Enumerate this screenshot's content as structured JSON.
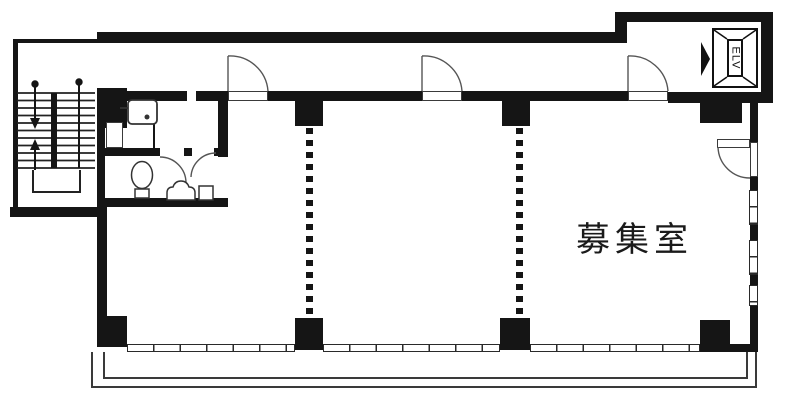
{
  "plan": {
    "room_label": "募集室",
    "elevator_label": "ELV"
  },
  "colors": {
    "wall": "#151515",
    "line": "#3a3a3a",
    "background": "#ffffff"
  },
  "features": [
    "staircase",
    "stair-up-down-arrows",
    "elevator",
    "elevator-direction-arrow",
    "corridor-swing-doors",
    "partition-dotted-lines",
    "window-band",
    "balcony",
    "toilet",
    "slop-sink",
    "washbasin"
  ]
}
